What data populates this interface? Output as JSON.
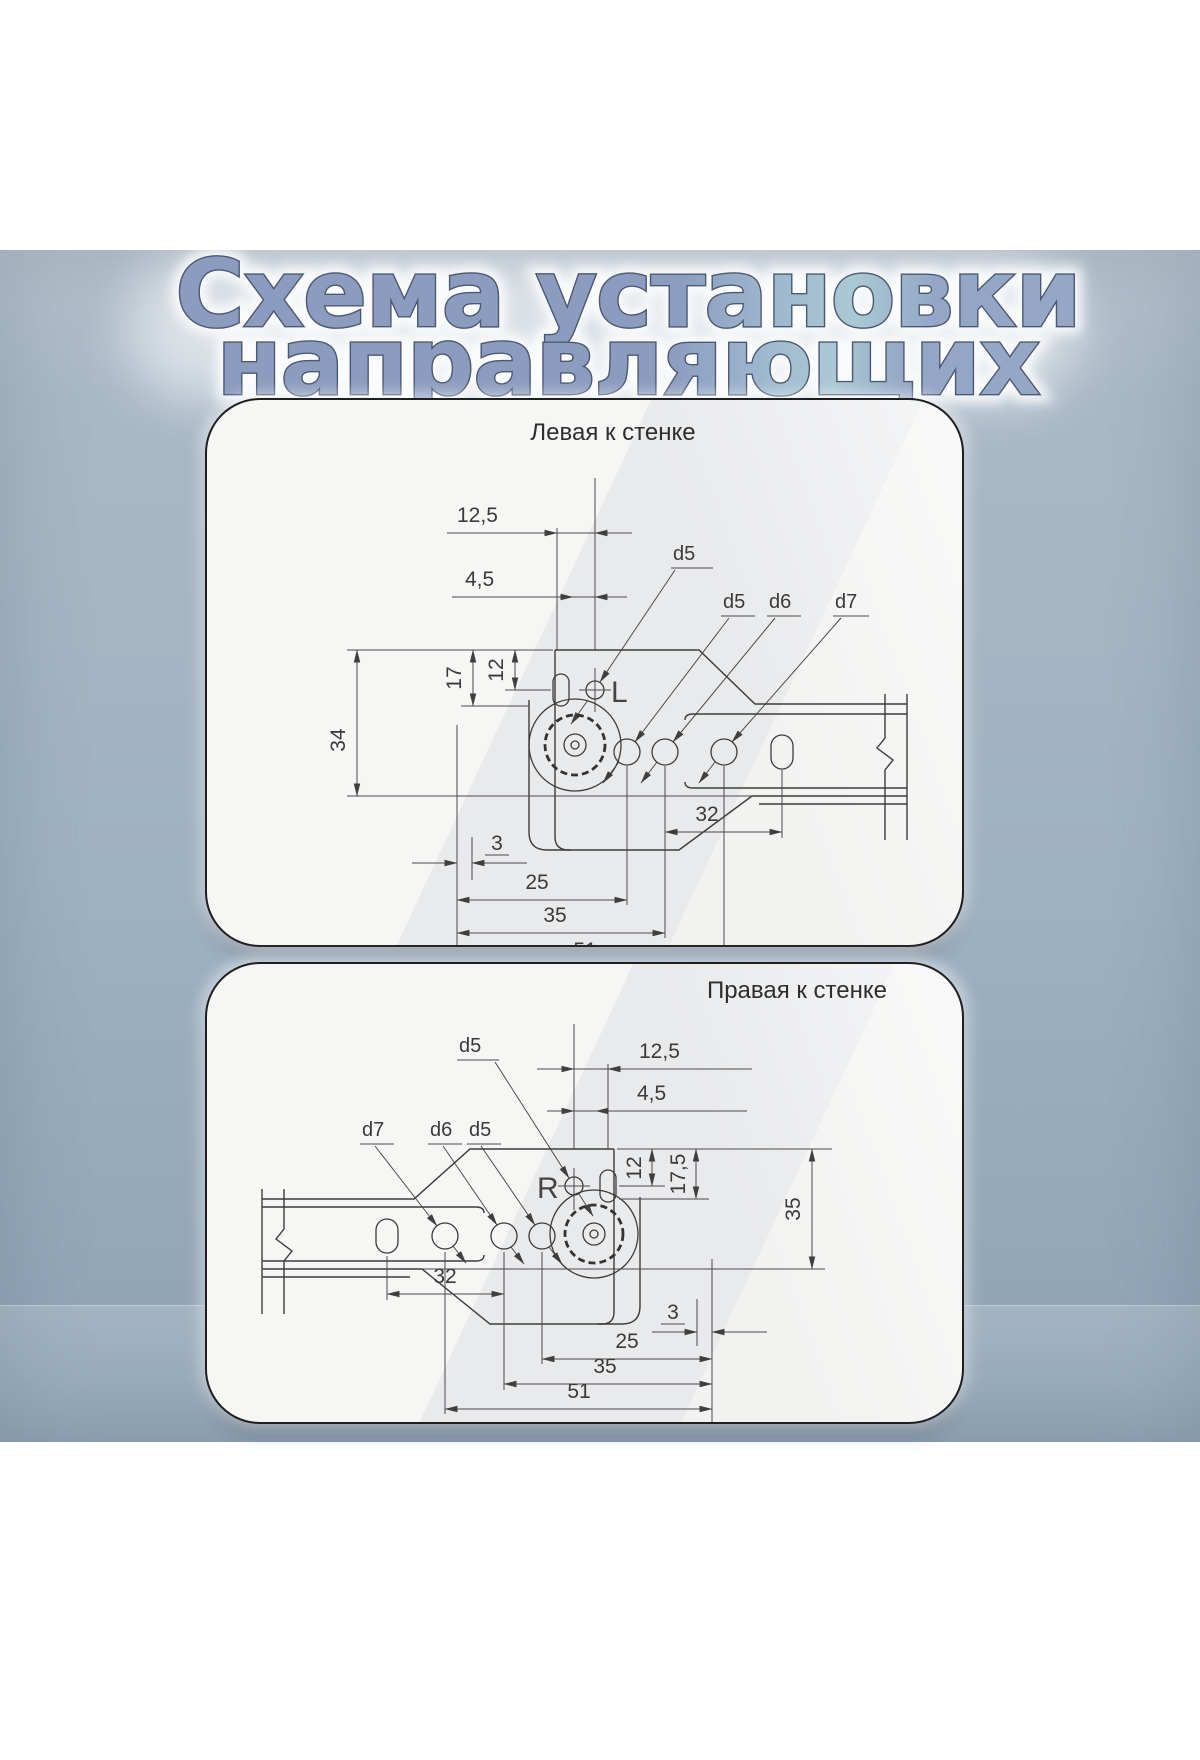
{
  "title": {
    "line1": "Схема установки",
    "line2": "направляющих"
  },
  "panel_left": {
    "caption": "Левая к стенке",
    "marking": "L",
    "labels": {
      "dim_12_5": "12,5",
      "dim_4_5": "4,5",
      "hole_d5_top": "d5",
      "hole_d5": "d5",
      "hole_d6": "d6",
      "hole_d7": "d7",
      "dim_34": "34",
      "dim_17": "17",
      "dim_12": "12",
      "dim_3": "3",
      "dim_25": "25",
      "dim_32": "32",
      "dim_35": "35",
      "dim_51": "51"
    }
  },
  "panel_right": {
    "caption": "Правая к стенке",
    "marking": "R",
    "labels": {
      "dim_12_5": "12,5",
      "dim_4_5": "4,5",
      "hole_d5_top": "d5",
      "hole_d5": "d5",
      "hole_d6": "d6",
      "hole_d7": "d7",
      "dim_35_vert": "35",
      "dim_17_5": "17,5",
      "dim_12": "12",
      "dim_3": "3",
      "dim_25": "25",
      "dim_32": "32",
      "dim_35": "35",
      "dim_51": "51"
    }
  },
  "colors": {
    "background_blue": "#9fb2c2",
    "panel_fill": "#f3f3f1",
    "drawing_line": "#3c3c3c",
    "title_fill": "#8b9cbf",
    "title_fill_light": "#aac9d4",
    "title_stroke": "#4b5873"
  }
}
